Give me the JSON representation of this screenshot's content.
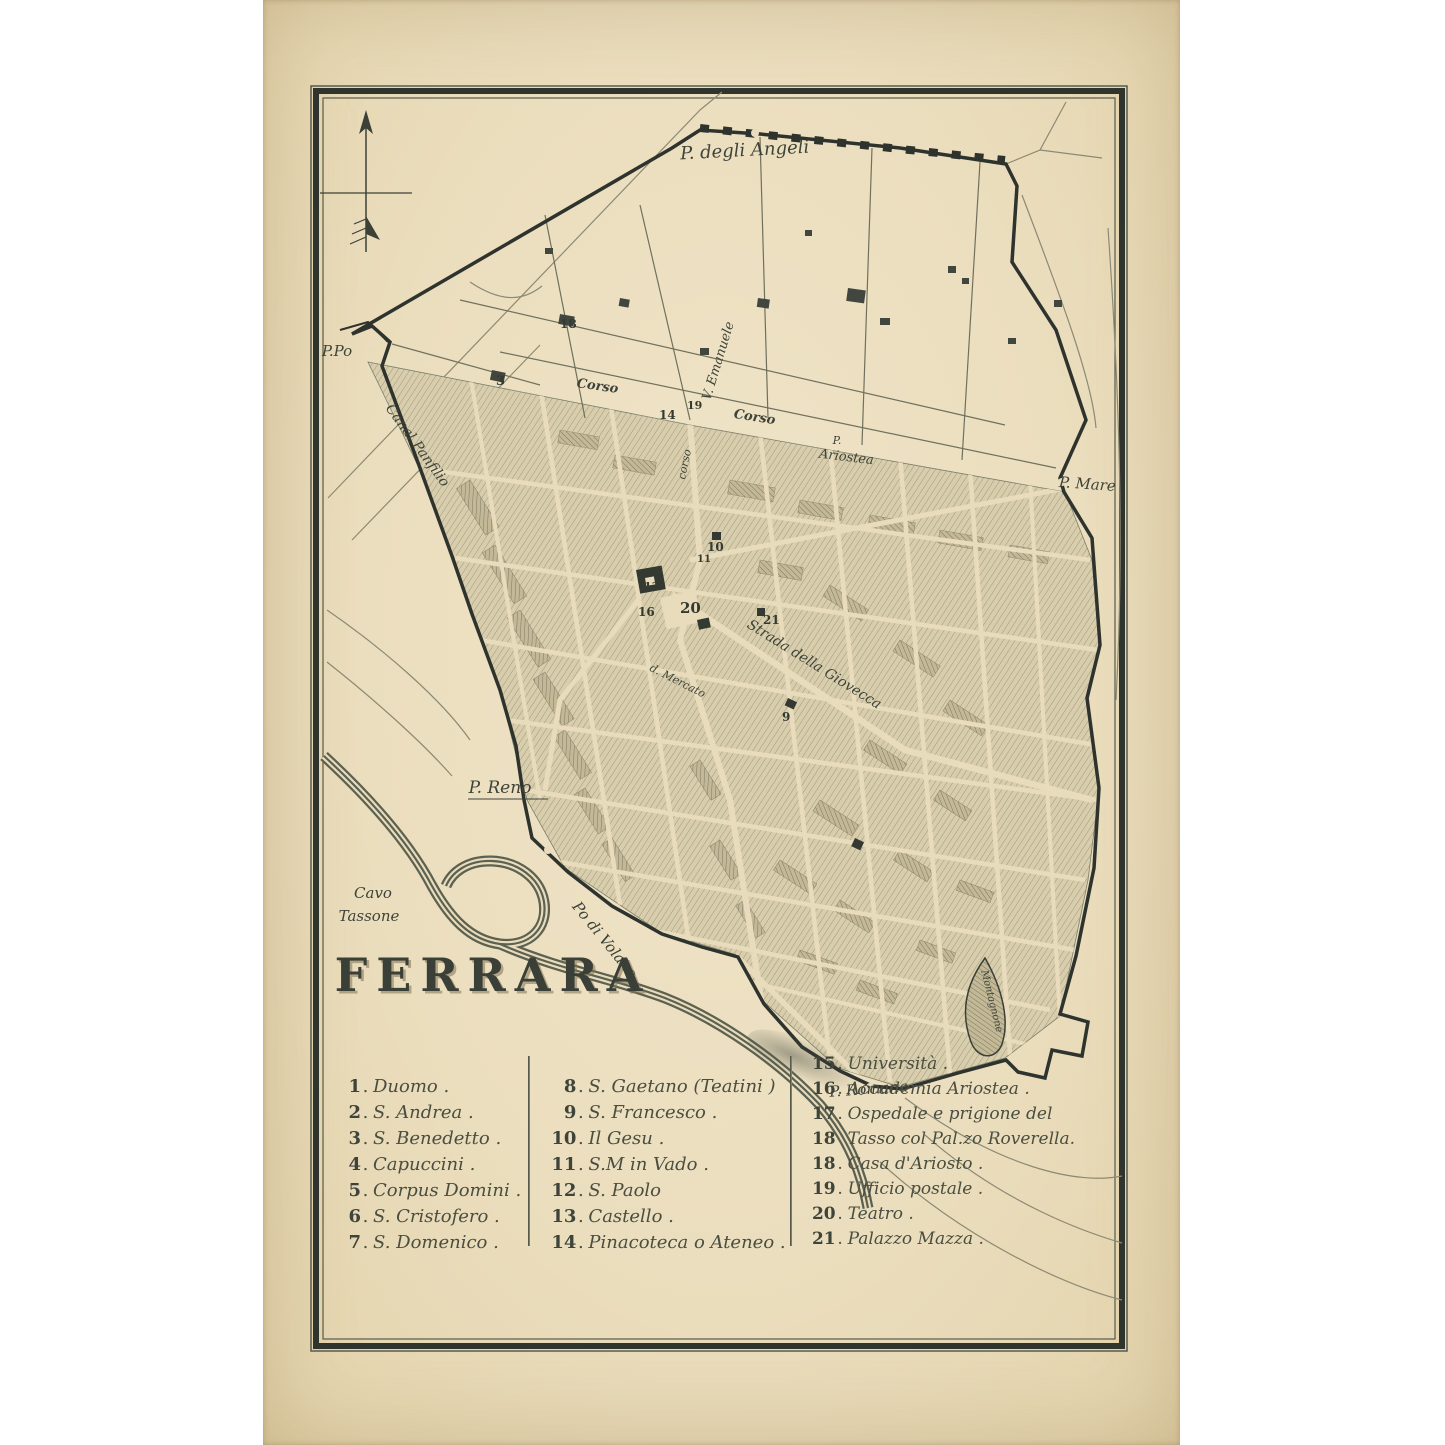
{
  "title": "FERRARA",
  "map": {
    "labels": [
      {
        "text": "P. degli Angeli"
      },
      {
        "text": "P.Po"
      },
      {
        "text": "Canal Panfilio"
      },
      {
        "text": "Corso"
      },
      {
        "text": "V. Emanuele"
      },
      {
        "text": "Corso"
      },
      {
        "text": "corso"
      },
      {
        "text": "P."
      },
      {
        "text": "Ariostea"
      },
      {
        "text": "P. Mare"
      },
      {
        "text": "Strada della Giovecca"
      },
      {
        "text": "d. Mercato"
      },
      {
        "text": "P. Reno"
      },
      {
        "text": "Cavo"
      },
      {
        "text": "Tassone"
      },
      {
        "text": "Po di Volano"
      },
      {
        "text": "Montagnone"
      },
      {
        "text": "P. Romana"
      }
    ],
    "numbers": [
      {
        "t": "18"
      },
      {
        "t": "3"
      },
      {
        "t": "14"
      },
      {
        "t": "19"
      },
      {
        "t": "10"
      },
      {
        "t": "11"
      },
      {
        "t": "13"
      },
      {
        "t": "16"
      },
      {
        "t": "20"
      },
      {
        "t": "21"
      },
      {
        "t": "9"
      }
    ]
  },
  "legend": {
    "columns": [
      {
        "items": [
          {
            "num": "1",
            "t": "Duomo ."
          },
          {
            "num": "2",
            "t": "S. Andrea ."
          },
          {
            "num": "3",
            "t": "S. Benedetto ."
          },
          {
            "num": "4",
            "t": "Capuccini ."
          },
          {
            "num": "5",
            "t": "Corpus Domini ."
          },
          {
            "num": "6",
            "t": "S. Cristofero ."
          },
          {
            "num": "7",
            "t": "S. Domenico ."
          }
        ]
      },
      {
        "items": [
          {
            "num": "8",
            "t": "S. Gaetano (Teatini )"
          },
          {
            "num": "9",
            "t": "S. Francesco ."
          },
          {
            "num": "10",
            "t": "Il Gesu ."
          },
          {
            "num": "11",
            "t": "S.M in Vado ."
          },
          {
            "num": "12",
            "t": "S. Paolo"
          },
          {
            "num": "13",
            "t": "Castello ."
          },
          {
            "num": "14",
            "t": "Pinacoteca o Ateneo ."
          }
        ]
      },
      {
        "items": [
          {
            "num": "15",
            "t": "Università ."
          },
          {
            "num": "16",
            "t": "Accademia Ariostea ."
          },
          {
            "num": "17",
            "t": "Ospedale e prigione del"
          },
          {
            "num": "18",
            "t": "Tasso col Pal.zo Roverella."
          },
          {
            "num": "18",
            "t": "Casa d'Ariosto ."
          },
          {
            "num": "19",
            "t": "Ufficio postale ."
          },
          {
            "num": "20",
            "t": "Teatro ."
          },
          {
            "num": "21",
            "t": "Palazzo Mazza ."
          }
        ]
      }
    ]
  }
}
